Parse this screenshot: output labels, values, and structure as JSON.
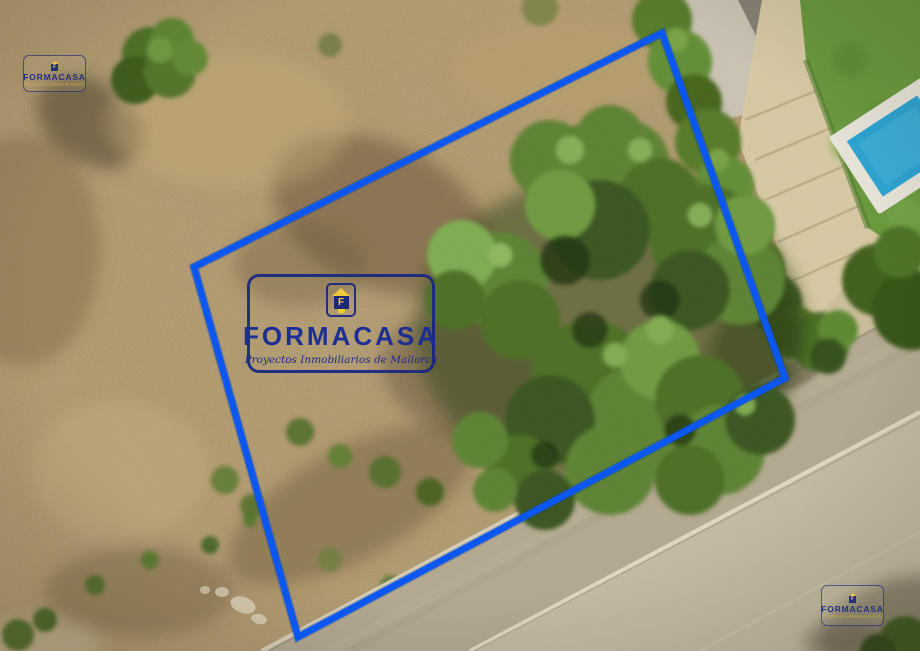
{
  "brand": {
    "name": "FORMACASA",
    "monogram": "F",
    "tagline": "Proyectos Inmobiliarios de Mallorca"
  },
  "colors": {
    "boundary_blue": "#0b57ef",
    "logo_navy": "#1c2e8f",
    "logo_yellow": "#eec93d"
  }
}
